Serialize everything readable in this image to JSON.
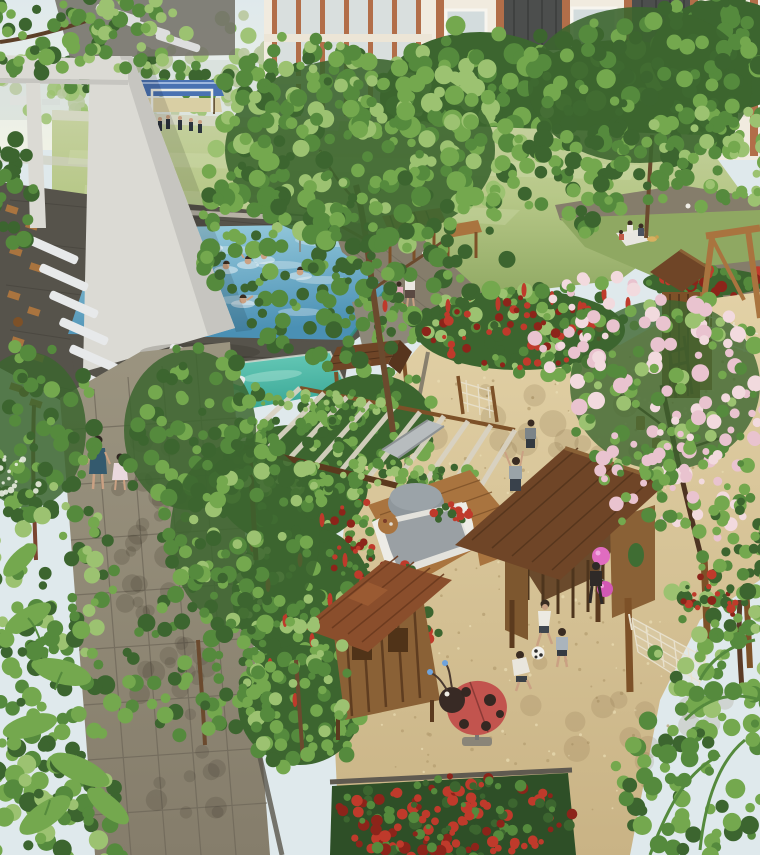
{
  "meta": {
    "title": "Residential courtyard aerial rendering",
    "type": "architectural-render",
    "view": "high-angle aerial view of a condominium landscape courtyard",
    "width_px": 760,
    "height_px": 855
  },
  "scene": {
    "description": "Aerial rendering of a lush residential courtyard: a blue swimming pool with swimmers and a turquoise children's pool beside a white shade structure and rows of sun loungers, a grey paver garden path with a mother and child walking, tropical planting with red ginger flowers, a vine-covered pergola with a slide, a wishing-well playhouse, a sandy playground with two timber playhouses, a ladybug spring rider, children playing football, a child holding pink balloons, a rope hammock, a timber climbing tower with swing frame, a green sports field with players and a blue-roofed pavilion, picnickers on a lawn, all framed by apartment buildings with terracotta and charcoal facades.",
    "areas": [
      {
        "id": "sports-field",
        "label": "Green sports field with players and blue-roofed pavilion"
      },
      {
        "id": "apartment-buildings",
        "label": "Apartment blocks with terracotta frames and charcoal panels"
      },
      {
        "id": "swimming-pool",
        "label": "Main swimming pool with six swimmers"
      },
      {
        "id": "kids-pool",
        "label": "Turquoise children's pool"
      },
      {
        "id": "sun-deck",
        "label": "Timber deck with white sun loungers and cafe chairs"
      },
      {
        "id": "white-shade-structure",
        "label": "White portal shade structure"
      },
      {
        "id": "garden-path",
        "label": "Grey paver walkway through tropical gardens"
      },
      {
        "id": "vine-pergola",
        "label": "Vine-covered pergola with slide"
      },
      {
        "id": "wishing-well-playhouse",
        "label": "Wishing-well timber playhouse"
      },
      {
        "id": "cabana",
        "label": "Outdoor sofa lounge with pouf and side table"
      },
      {
        "id": "playhouse-large",
        "label": "Large timber playhouse with shingle roof"
      },
      {
        "id": "playhouse-small",
        "label": "Small timber playhouse with dormer roof"
      },
      {
        "id": "ladybug-rider",
        "label": "Ladybug spring rider toy"
      },
      {
        "id": "hammock",
        "label": "Rope hammock between timber posts"
      },
      {
        "id": "climbing-tower",
        "label": "Climbing tower with rope bridge and swing frame"
      },
      {
        "id": "sand-playground",
        "label": "Sand play area with children playing football"
      },
      {
        "id": "flower-beds",
        "label": "Red flower beds and ginger plants"
      },
      {
        "id": "picnic-lawn",
        "label": "Lawn with picnicking family"
      }
    ],
    "people": {
      "swimmers": 6,
      "field_players": 8,
      "path_walkers": 2,
      "promenade_walkers": 3,
      "children_playing": 6,
      "picnickers": 3
    }
  },
  "colors": {
    "sky-top": "#dfe9ec",
    "sky-bottom": "#f0f2e6",
    "haze": "#cdd8d3",
    "field-light": "#b7c888",
    "field-dark": "#8fa862",
    "field-far": "#c6d1a0",
    "pavilion-blue": "#4a72b2",
    "building-wall": "#f1ebdf",
    "building-frame": "#b26e49",
    "building-panel": "#4c4e4d",
    "window-glass": "#d3dcdd",
    "structure-white": "#dbdad4",
    "structure-shade": "#c6c5c0",
    "deck-dark": "#56534b",
    "deck-line": "#47443d",
    "lounger": "#e7e9ea",
    "wood-light": "#a9743f",
    "wood-mid": "#7d5128",
    "wood-dark": "#5b3a1e",
    "roof-brown": "#6f4527",
    "roof-red": "#8a4e2c",
    "pool-light": "#9dcfe0",
    "pool-deep": "#4a90b4",
    "coping-teal": "#2e8f80",
    "kidspool-light": "#6ecfbd",
    "kidspool-deep": "#2f9f8e",
    "path-light": "#9b9480",
    "path-mid": "#857d6b",
    "path-grout": "#6e6759",
    "sand-light": "#e2d1a6",
    "sand-mid": "#c9b385",
    "sand-speck": "#b49d6f",
    "sand-speck-light": "#eaddb4",
    "leaf-dark": "#3c652f",
    "leaf-mid": "#558a3d",
    "leaf-light": "#74a84e",
    "leaf-pale": "#9cc271",
    "leaf-haze": "#bac9a1",
    "blossom-pink": "#e9c3cf",
    "blossom-light": "#f2dade",
    "flower-red": "#bf3a2b",
    "flower-red-dark": "#8c241a",
    "ladybug-red": "#c2544e",
    "ladybug-dark": "#382a25",
    "balloon-pink": "#e06cc0",
    "hammock": "#e9e2cf",
    "skin": "#caa183",
    "trunk": "#6b4a2e"
  }
}
